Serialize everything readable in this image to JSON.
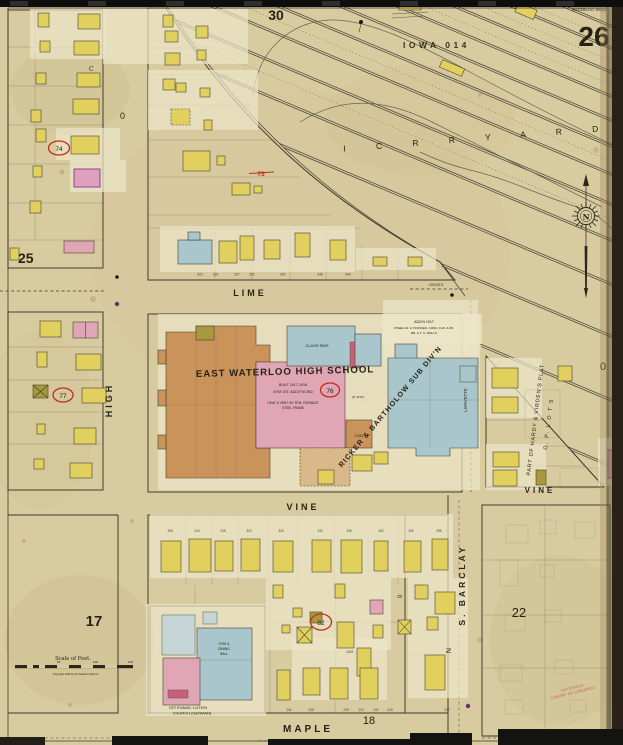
{
  "sheet": {
    "number": "26",
    "city_line": "WATERLOO, IOWA",
    "catalog_stamp": "IOWA 014",
    "adjacent_top": "30",
    "adjacent_left": "25"
  },
  "block_numbers": {
    "b17": "17",
    "b18": "18",
    "b22": "22"
  },
  "streets": {
    "lime": "LIME",
    "vine": "VINE",
    "vine_east": "VINE",
    "maple": "MAPLE",
    "high": "HIGH",
    "barclay": "S. BARCLAY",
    "lafayette": "LAFAYETTE"
  },
  "railroad": {
    "yard_label": "I C R R   Y A R D"
  },
  "school": {
    "name": "EAST WATERLOO HIGH SCHOOL",
    "class_rooms": "CLASS RMS",
    "built": "BUILT 1917-1918",
    "gym": "GYM 1ST, AUDIT'M 2ND",
    "heat_1": "HEAT & VENT. BY STM. FURNACE",
    "heat_2": "STEEL FRAME",
    "addition_1": "ADD'N 1917",
    "addition_2": "STEEL FR. & TRUSSES, CONC. FLR. & RF.",
    "addition_3": "BR. & T. C. WALLS",
    "coal": "COAL",
    "water_main": "(6\" W.M.)"
  },
  "subdivisions": {
    "ricker": "RICKER & BARTHOLOW SUB DIV'N",
    "hardy": "PART OF HARDY & VIRDEN'S PLAT",
    "op_lots": "O. P.  L O T S"
  },
  "church": {
    "hall_1": "GYM &",
    "hall_2": "DINING",
    "hall_3": "HALL",
    "name_1": "1ST EVANG. LUTH'N",
    "name_2": "CHURCH (GERMAN)"
  },
  "refs": {
    "r74": "74",
    "r75": "75",
    "r76": "76",
    "r77": "77",
    "r82": "82"
  },
  "scale_bar": {
    "title": "Scale of Feet.",
    "copyright": "Copyright 1919 by the Sanborn Map Co.",
    "tick_50": "50",
    "tick_100": "100",
    "tick_150": "150"
  },
  "marks": {
    "c_mark": "C",
    "n_mark": "N",
    "zero_high": "0",
    "zero_right": "0",
    "zero_alley": "0",
    "crossing": "CROSS'G",
    "house_1305": "1305"
  },
  "loc_stamp": {
    "line_1": "MAP DIVISION",
    "line_2": "LIBRARY OF CONGRESS"
  },
  "compass": {
    "north": "N"
  },
  "palette": {
    "paper": "#d8cb9f",
    "frame_yellow": "#e2d05e",
    "brick_pink": "#e0a6b6",
    "stone_blue": "#a9c6cd",
    "special_brown": "#c9935a",
    "annotation_red": "#bf2e1c"
  },
  "house_numbers": {
    "lime": {
      "y": 275.5,
      "items": [
        {
          "t": "823",
          "x": 200
        },
        {
          "t": "821",
          "x": 216
        },
        {
          "t": "827",
          "x": 237
        },
        {
          "t": "831",
          "x": 252
        },
        {
          "t": "833",
          "x": 283
        },
        {
          "t": "839",
          "x": 320
        },
        {
          "t": "843",
          "x": 348
        }
      ]
    },
    "vine": {
      "y": 532,
      "items": [
        {
          "t": "306",
          "x": 170
        },
        {
          "t": "314",
          "x": 197
        },
        {
          "t": "318",
          "x": 223
        },
        {
          "t": "322",
          "x": 249
        },
        {
          "t": "326",
          "x": 281
        },
        {
          "t": "332",
          "x": 320
        },
        {
          "t": "336",
          "x": 349
        },
        {
          "t": "342",
          "x": 381
        },
        {
          "t": "350",
          "x": 411
        },
        {
          "t": "356",
          "x": 439
        }
      ]
    },
    "maple": {
      "y": 711,
      "items": [
        {
          "t": "241",
          "x": 289
        },
        {
          "t": "239",
          "x": 311
        },
        {
          "t": "235",
          "x": 346
        },
        {
          "t": "233",
          "x": 361
        },
        {
          "t": "231",
          "x": 376
        },
        {
          "t": "229",
          "x": 390
        },
        {
          "t": "227",
          "x": 447
        }
      ]
    }
  }
}
